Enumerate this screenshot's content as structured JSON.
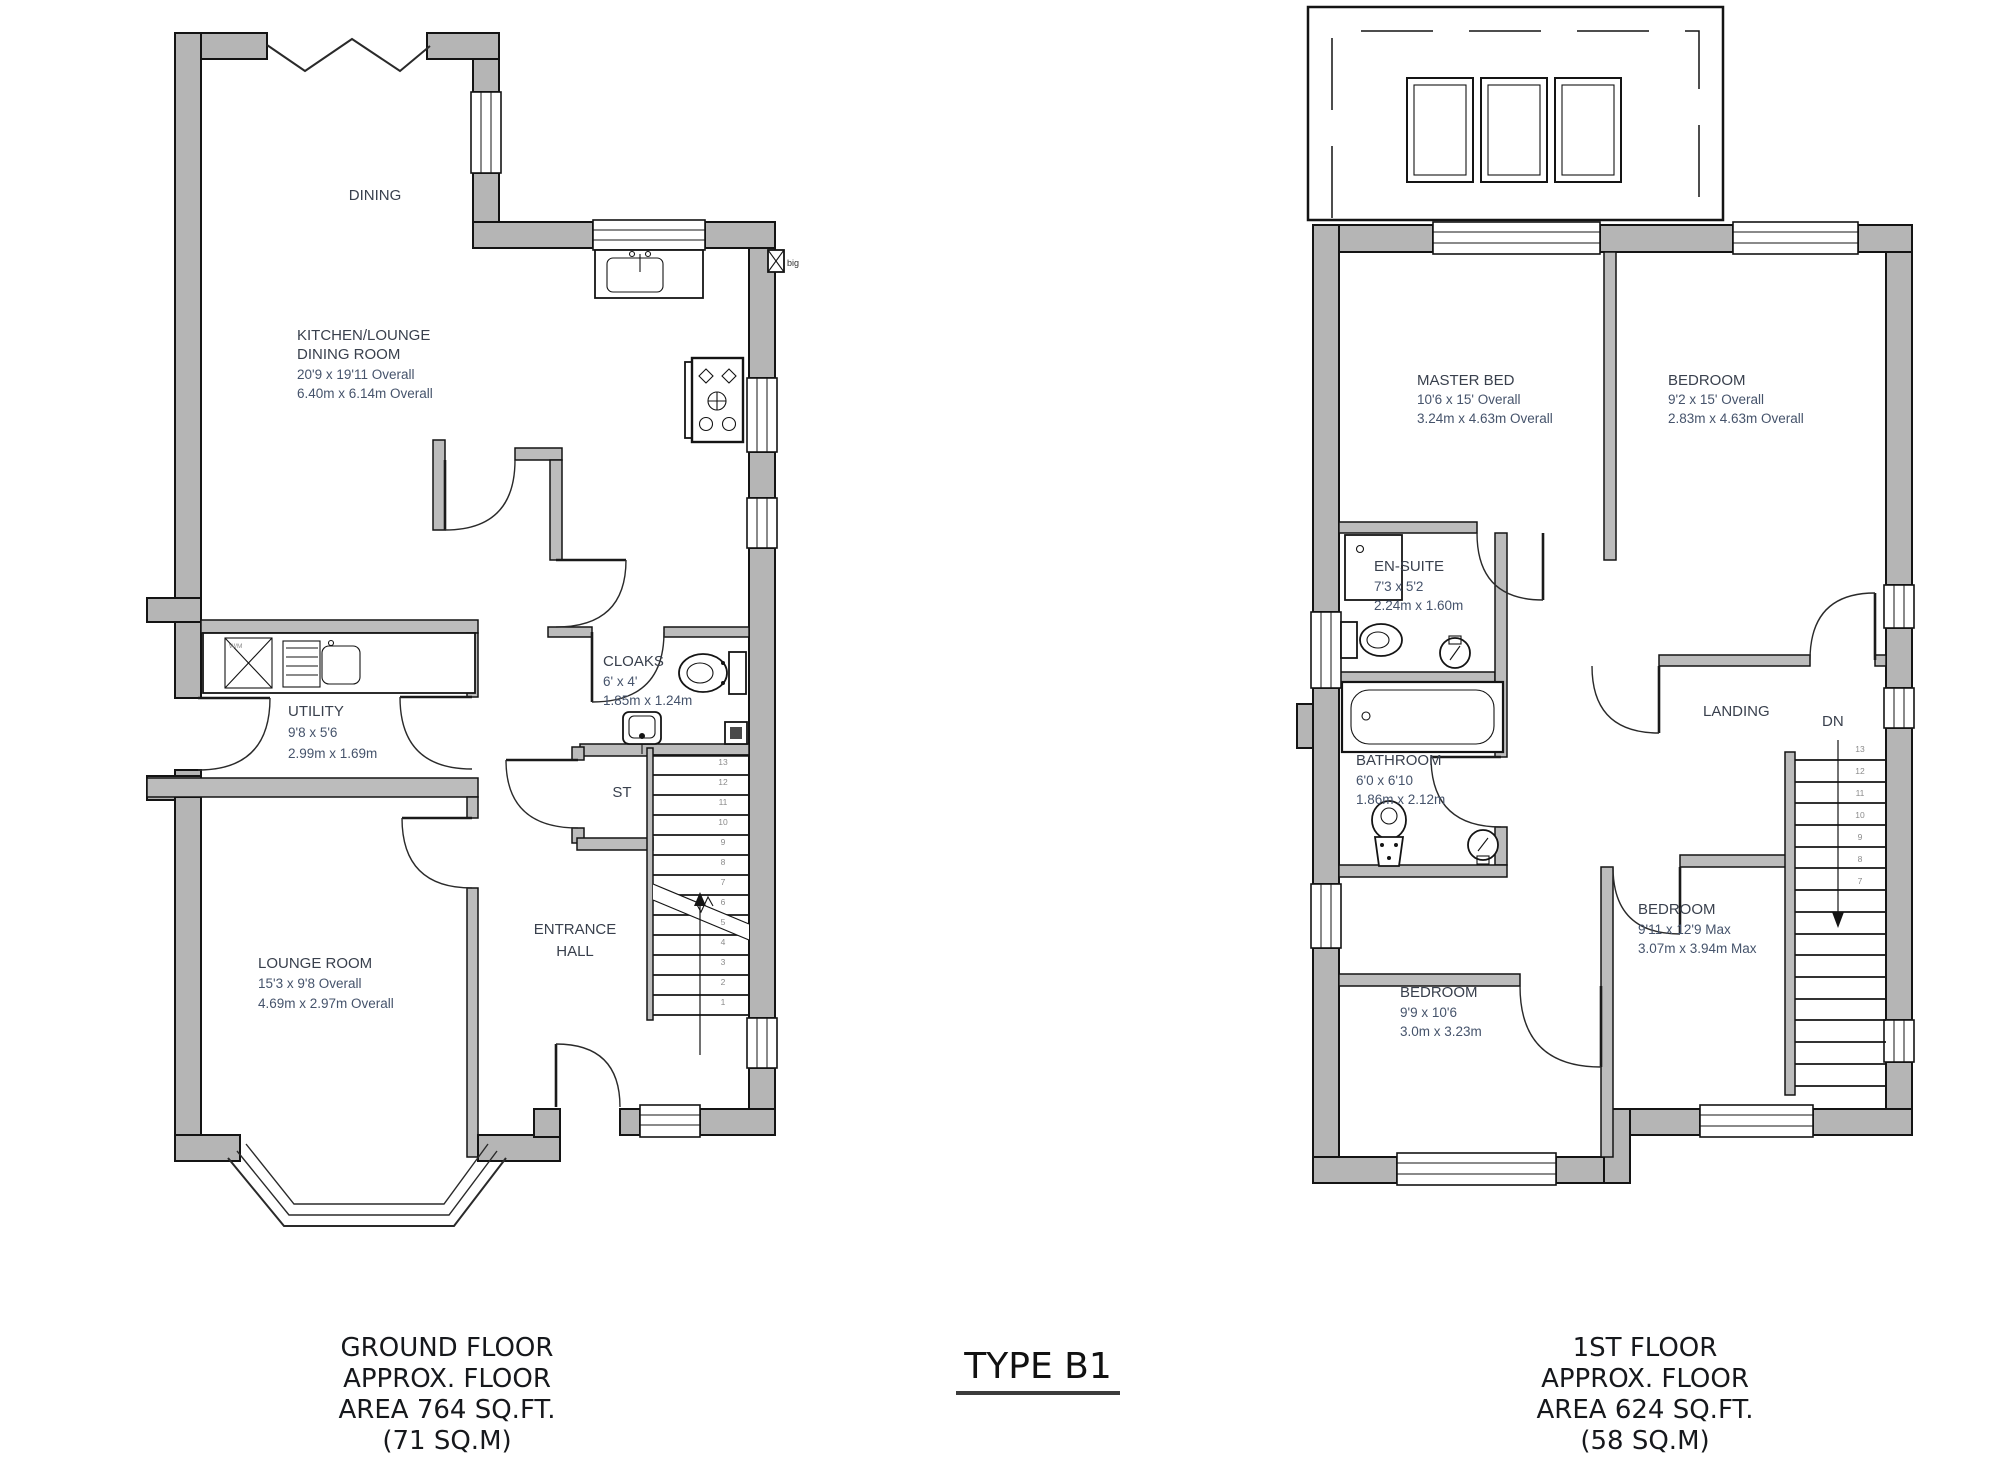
{
  "plan_title": "TYPE B1",
  "ground_floor": {
    "caption": [
      "GROUND FLOOR",
      "APPROX. FLOOR",
      "AREA 764 SQ.FT.",
      "(71 SQ.M)"
    ],
    "rooms": {
      "dining": {
        "name": "DINING"
      },
      "kitchen": {
        "name_line1": "KITCHEN/LOUNGE",
        "name_line2": "DINING ROOM",
        "dim_imperial": "20'9 x 19'11 Overall",
        "dim_metric": "6.40m x 6.14m Overall"
      },
      "utility": {
        "name": "UTILITY",
        "d4im": "",
        "dim_imperial": "9'8 x 5'6",
        "dim_metric": "2.99m x 1.69m"
      },
      "cloaks": {
        "name": "CLOAKS",
        "dim_imperial": "6' x 4'",
        "dim_metric": "1.85m x 1.24m"
      },
      "store": {
        "name": "ST"
      },
      "entrance_hall": {
        "name_line1": "ENTRANCE",
        "name_line2": "HALL"
      },
      "lounge": {
        "name": "LOUNGE ROOM",
        "dim_imperial": "15'3 x 9'8 Overall",
        "dim_metric": "4.69m x 2.97m Overall"
      }
    },
    "washer_label": "W/M",
    "boiler_label": "big",
    "stair_numbers": [
      "13",
      "12",
      "11",
      "10",
      "9",
      "8",
      "7",
      "6",
      "5",
      "4",
      "3",
      "2",
      "1"
    ]
  },
  "first_floor": {
    "caption": [
      "1ST FLOOR",
      "APPROX. FLOOR",
      "AREA 624 SQ.FT.",
      "(58 SQ.M)"
    ],
    "rooms": {
      "master_bed": {
        "name": "MASTER BED",
        "dim_imperial": "10'6 x 15' Overall",
        "dim_metric": "3.24m x 4.63m Overall"
      },
      "bedroom_2": {
        "name": "BEDROOM",
        "dim_imperial": "9'2 x 15' Overall",
        "dim_metric": "2.83m x 4.63m Overall"
      },
      "en_suite": {
        "name": "EN-SUITE",
        "dim_imperial": "7'3 x 5'2",
        "dim_metric": "2.24m x 1.60m"
      },
      "bathroom": {
        "name": "BATHROOM",
        "dim_imperial": "6'0 x 6'10",
        "dim_metric": "1.86m x 2.12m"
      },
      "landing": {
        "name": "LANDING"
      },
      "bedroom_3": {
        "name": "BEDROOM",
        "dim_imperial": "9'11 x 12'9 Max",
        "dim_metric": "3.07m x 3.94m Max"
      },
      "bedroom_4": {
        "name": "BEDROOM",
        "dim_imperial": "9'9 x 10'6",
        "dim_metric": "3.0m x 3.23m"
      }
    },
    "stairs_label": "DN",
    "stair_numbers": [
      "13",
      "12",
      "11",
      "10",
      "9",
      "8",
      "7"
    ]
  }
}
